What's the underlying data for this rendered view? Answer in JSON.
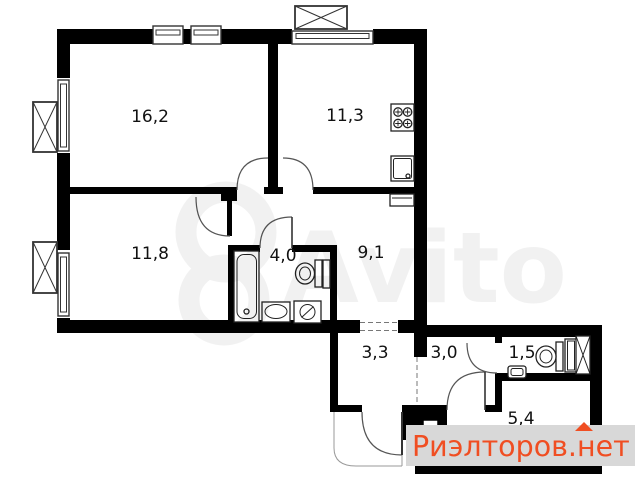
{
  "plan": {
    "type": "apartment-floor-plan",
    "rooms": [
      {
        "key": "living-room",
        "area": "16,2"
      },
      {
        "key": "kitchen",
        "area": "11,3"
      },
      {
        "key": "bedroom",
        "area": "11,8"
      },
      {
        "key": "bathroom",
        "area": "4,0"
      },
      {
        "key": "hallway",
        "area": "9,1"
      },
      {
        "key": "corridor",
        "area": "3,3"
      },
      {
        "key": "entry-hall",
        "area": "3,0"
      },
      {
        "key": "wc",
        "area": "1,5"
      },
      {
        "key": "pantry",
        "area": "5,4"
      }
    ],
    "fixtures": [
      {
        "icon": "stove-icon",
        "room": "kitchen"
      },
      {
        "icon": "kitchen-sink-icon",
        "room": "kitchen"
      },
      {
        "icon": "radiator-icon",
        "room": "hallway"
      },
      {
        "icon": "bathtub-icon",
        "room": "bathroom"
      },
      {
        "icon": "toilet-icon",
        "room": "bathroom"
      },
      {
        "icon": "washbasin-icon",
        "room": "bathroom"
      },
      {
        "icon": "washing-machine-icon",
        "room": "bathroom"
      },
      {
        "icon": "cabinet-icon",
        "room": "bathroom"
      },
      {
        "icon": "toilet-icon",
        "room": "wc"
      },
      {
        "icon": "hand-basin-icon",
        "room": "wc"
      },
      {
        "icon": "shower-screen-icon",
        "room": "wc"
      },
      {
        "icon": "duct-icon",
        "room": "wc"
      },
      {
        "icon": "vent-shaft-icon",
        "room": "entry-hall"
      }
    ],
    "openings": [
      "living-room-door",
      "kitchen-door",
      "bedroom-door",
      "bathroom-door",
      "wc-door",
      "pantry-door",
      "entrance-door"
    ],
    "windows": 5,
    "balconies": 3
  },
  "watermarks": {
    "center_logo_text": "Avito",
    "bottom_band": {
      "text": "Риэлторов.нет",
      "text_color": "#f04e22",
      "band_color": "#d8d8d8"
    }
  },
  "colors": {
    "wall": "#000000",
    "background": "#ffffff",
    "door_arc": "#555555"
  }
}
